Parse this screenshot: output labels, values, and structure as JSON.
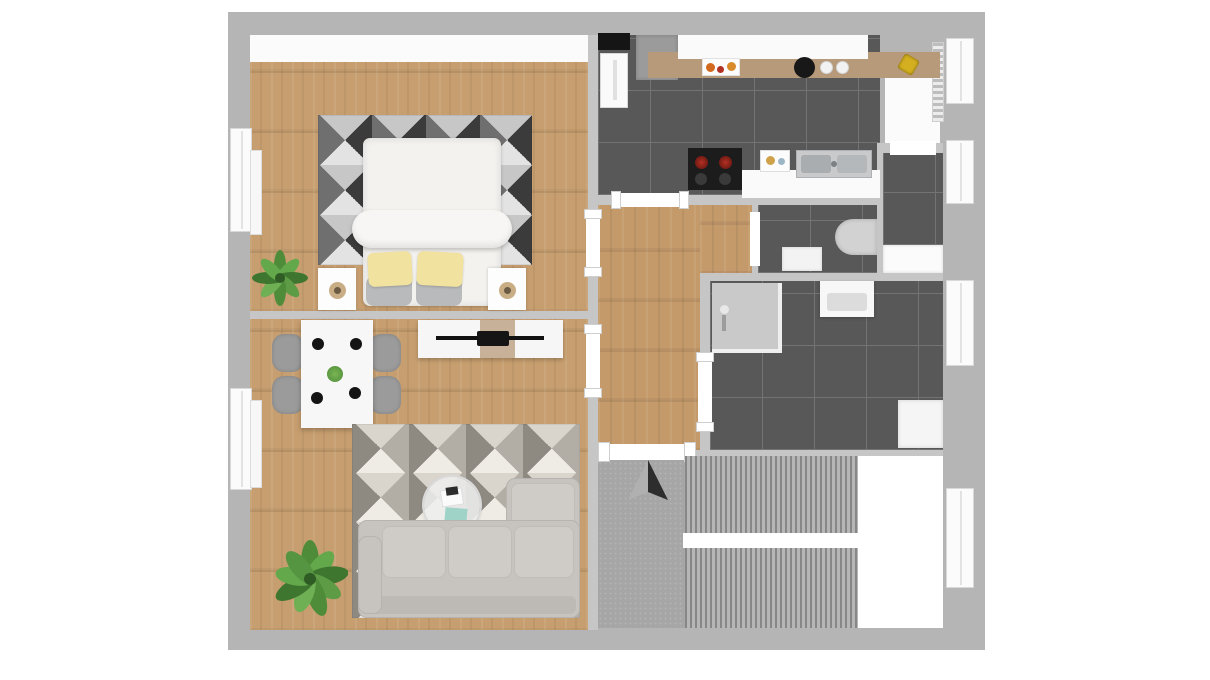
{
  "app": {
    "type": "floor-plan-3d-render",
    "view": "top-down",
    "title": "Apartment Floor Plan"
  },
  "colors": {
    "background": "#ffffff",
    "outer_wall": "#b5b5b5",
    "partition_wall": "#c6c6c6",
    "white_surface": "#fbfbfb",
    "wood_floor": "#c79e6f",
    "hallway_floor": "#c49a6b",
    "tile_floor": "#585858",
    "tile_grout": "#737373",
    "carpet": "#a6a6a6",
    "stair_tread_dark": "#878787",
    "counter_wood": "#b needsreplace",
    "sofa_fabric": "#c7c4bf",
    "sofa_fabric_light": "#cfccc7",
    "chair_gray": "#9b9b9b",
    "bed_white": "#f4f2ef",
    "pillow_yellow": "#f1e2a0",
    "pillow_gray": "#b9babc",
    "rug_dark_a": "#3b3b3b",
    "rug_dark_b": "#e3e3e3",
    "rug_dark_c": "#6f6f6f",
    "rug_dark_d": "#c7c7c7",
    "rug_light_a": "#b3aea5",
    "rug_light_b": "#efece6",
    "rug_light_c": "#8e8a82",
    "rug_light_d": "#d9d4cc",
    "plant_green_dark": "#3e7630",
    "plant_green_light": "#63a84b",
    "lamp_gold": "#c9ae85",
    "burner_red": "#b23024",
    "fruit_orange": "#d3691e",
    "accessory_yellow": "#d4af1f",
    "book_teal": "#9fd3c7",
    "arrow_light": "#b0b0b0",
    "arrow_dark": "#2d2d2d",
    "shower_gray": "#c9c9c9",
    "toilet_gray": "#d2d2d2",
    "counter_top_wood": "#b79a7a",
    "stove_black": "#1c1c1c"
  },
  "rooms": [
    {
      "id": "bedroom",
      "floor": "wood",
      "items": [
        "built-in-wardrobe",
        "double-bed",
        "rolled-blanket",
        "yellow-pillows",
        "gray-pillows",
        "geometric-rug-dark",
        "nightstand-left",
        "nightstand-right",
        "table-lamps",
        "potted-plant"
      ]
    },
    {
      "id": "living-room",
      "floor": "wood",
      "items": [
        "dining-table",
        "dining-chairs-4",
        "place-settings-4",
        "tv-sideboard",
        "flat-tv",
        "geometric-rug-light",
        "round-coffee-table",
        "books",
        "corner-sofa",
        "potted-plant-large"
      ]
    },
    {
      "id": "kitchen",
      "floor": "dark-tile",
      "items": [
        "door-mat",
        "fridge",
        "tall-cabinet",
        "upper-counter-wood",
        "fruit-tray",
        "kettle",
        "plates-2",
        "flower-accessory",
        "stove-red-burners",
        "base-cabinet",
        "double-sink",
        "lower-counter",
        "radiator"
      ]
    },
    {
      "id": "pantry",
      "floor": "dark-tile",
      "items": [
        "cabinet-white"
      ]
    },
    {
      "id": "wc",
      "floor": "dark-tile",
      "items": [
        "toilet",
        "cabinet-white"
      ]
    },
    {
      "id": "hallway",
      "floor": "wood",
      "items": []
    },
    {
      "id": "bathroom",
      "floor": "dark-tile",
      "items": [
        "corner-shower",
        "vanity-sink",
        "washing-machine"
      ]
    },
    {
      "id": "stairwell",
      "floor": "carpet",
      "items": [
        "upper-stair-flight",
        "lower-stair-flight",
        "landing",
        "stair-void",
        "north-arrow"
      ]
    }
  ],
  "openings": {
    "windows_left_wall": 2,
    "windows_right_wall": 4,
    "interior_doors": 7
  },
  "compass": {
    "present": true,
    "style": "split-triangle-arrow",
    "orientation": "up"
  }
}
